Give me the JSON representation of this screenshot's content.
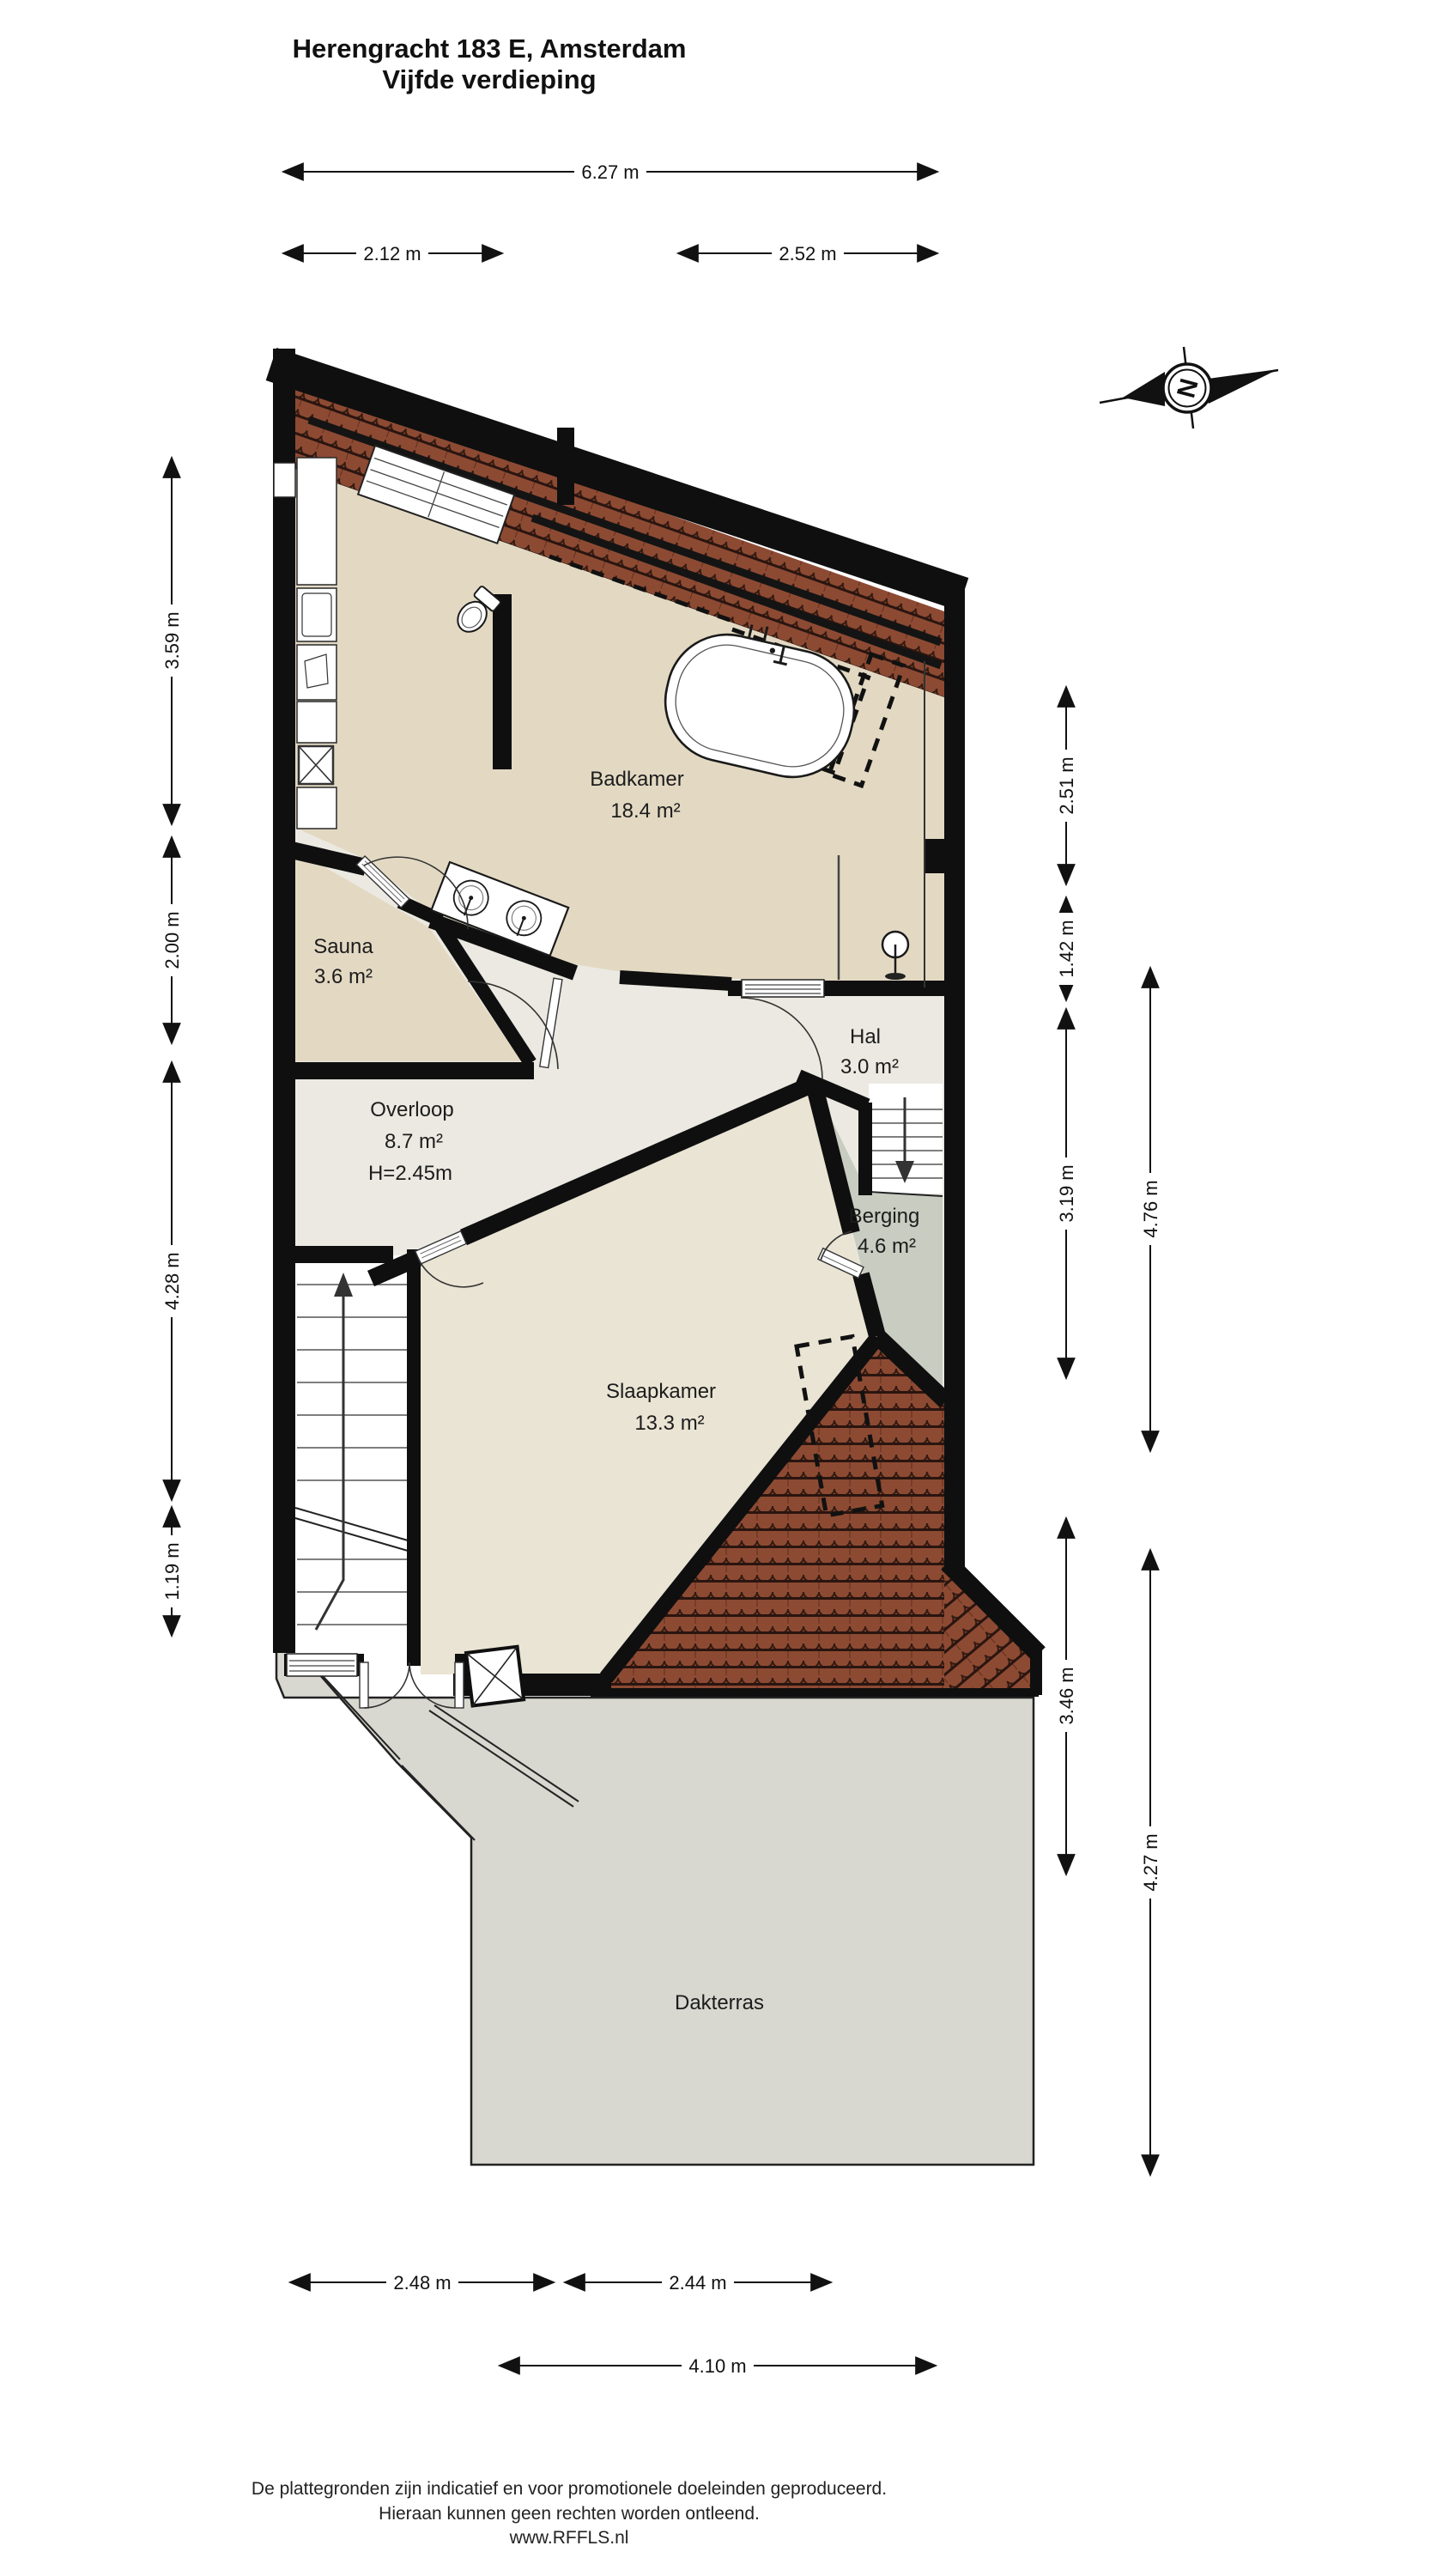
{
  "title": {
    "line1": "Herengracht 183 E, Amsterdam",
    "line2": "Vijfde verdieping"
  },
  "compass": {
    "letter": "N"
  },
  "rooms": {
    "badkamer": {
      "name": "Badkamer",
      "area": "18.4 m²"
    },
    "sauna": {
      "name": "Sauna",
      "area": "3.6 m²"
    },
    "hal": {
      "name": "Hal",
      "area": "3.0 m²"
    },
    "overloop": {
      "name": "Overloop",
      "area": "8.7 m²",
      "height": "H=2.45m"
    },
    "slaapkamer": {
      "name": "Slaapkamer",
      "area": "13.3 m²"
    },
    "berging": {
      "name": "Berging",
      "area": "4.6 m²"
    },
    "dakterras": {
      "name": "Dakterras"
    }
  },
  "dimensions": {
    "top": [
      "6.27 m",
      "2.12 m",
      "2.52 m"
    ],
    "left": [
      "3.59 m",
      "2.00 m",
      "4.28 m",
      "1.19 m"
    ],
    "right_inner": [
      "2.51 m",
      "1.42 m",
      "3.19 m",
      "3.46 m"
    ],
    "right_outer": [
      "4.76 m",
      "4.27 m"
    ],
    "bottom": [
      "2.48 m",
      "2.44 m",
      "4.10 m"
    ]
  },
  "footer": {
    "line1": "De plattegronden zijn indicatief en voor promotionele doeleinden geproduceerd.",
    "line2": "Hieraan kunnen geen rechten worden ontleend.",
    "line3": "www.RFFLS.nl"
  },
  "colors": {
    "wall": "#0f0f0f",
    "roof_tile": "#8d4a33",
    "roof_tile_dark": "#2a1510",
    "floor_bathroom": "#e3d9c3",
    "floor_landing": "#ebe9e1",
    "floor_bedroom": "#eae4d4",
    "floor_storage": "#c8ccc1",
    "floor_terrace": "#d8d8d0"
  }
}
